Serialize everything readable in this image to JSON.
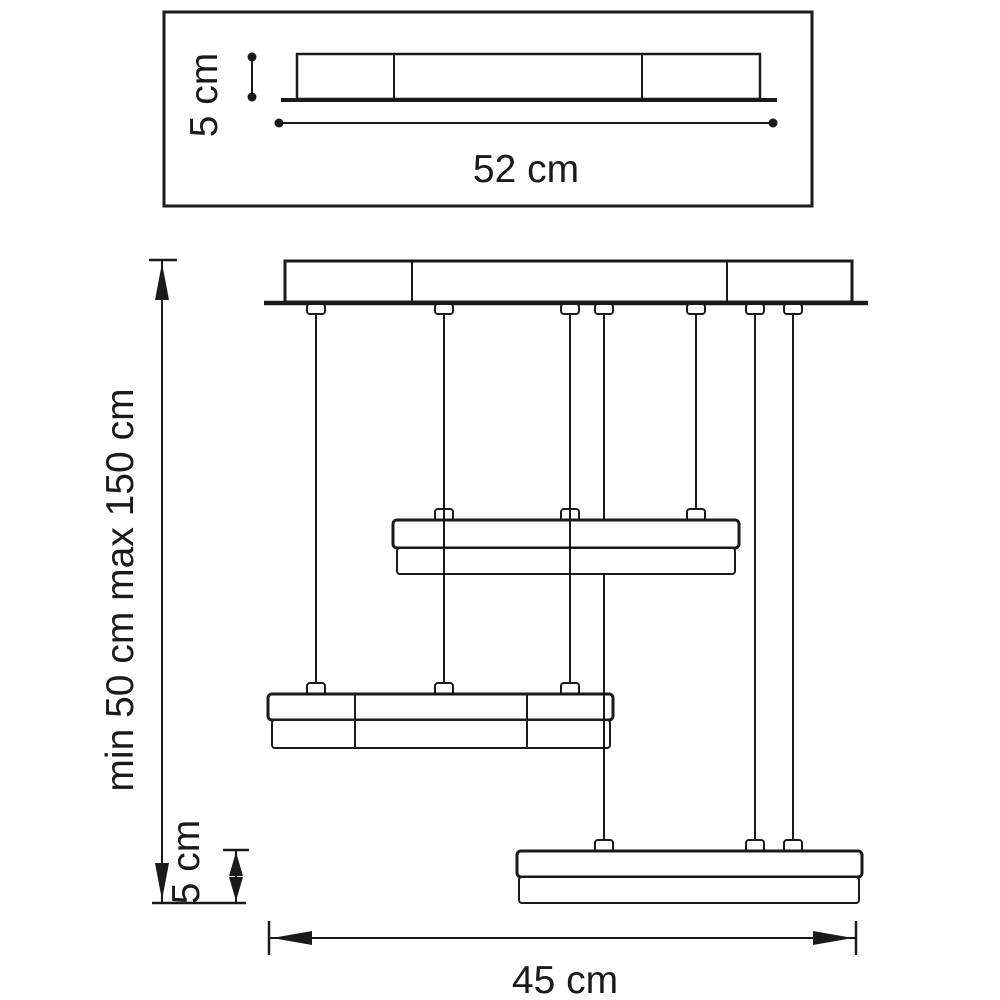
{
  "diagram": {
    "kind": "technical-dimension-drawing",
    "subject": "three-tier linear pendant chandelier with ceiling canopy",
    "colors": {
      "line": "#1a1a1a",
      "background": "#ffffff"
    },
    "top_view": {
      "height_label": "5 cm",
      "width_label": "52 cm"
    },
    "side_view": {
      "suspension_label": "min 50 cm max 150 cm",
      "bar_height_label": "5 cm",
      "overall_width_label": "45 cm",
      "wire_count": 7,
      "bar_count": 3
    }
  }
}
